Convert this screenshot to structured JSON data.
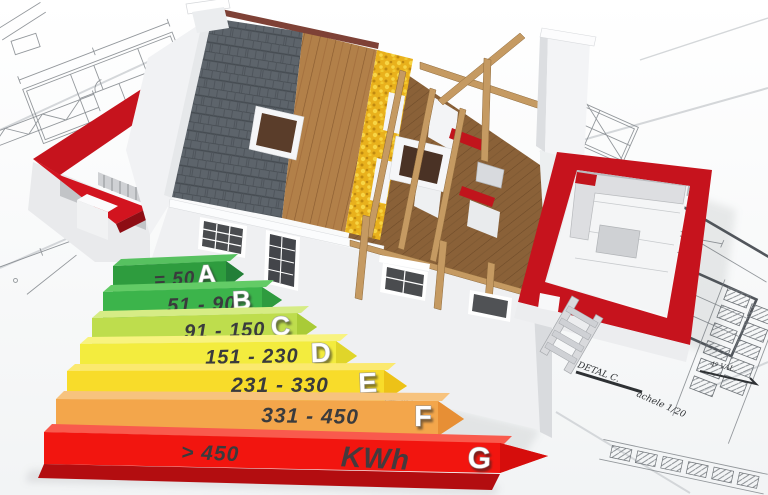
{
  "scene": {
    "description": "3D cutaway house under construction standing on architectural blueprints, with an energy-efficiency rating arrow scale in the foreground"
  },
  "energy_label": {
    "unit_label": "KWh",
    "ratings": [
      {
        "grade": "A",
        "range": "= 50",
        "front_color": "#2e9c3e",
        "top_color": "#57c160",
        "tip_color": "#237f38"
      },
      {
        "grade": "B",
        "range": "51 - 90",
        "front_color": "#3cb44b",
        "top_color": "#63cb66",
        "tip_color": "#2f9b3f"
      },
      {
        "grade": "C",
        "range": "91 - 150",
        "front_color": "#bedd4d",
        "top_color": "#d6ec85",
        "tip_color": "#a9cb37"
      },
      {
        "grade": "D",
        "range": "151 - 230",
        "front_color": "#f3ec3e",
        "top_color": "#f8f37f",
        "tip_color": "#e0d52a"
      },
      {
        "grade": "E",
        "range": "231 - 330",
        "front_color": "#f8dc2a",
        "top_color": "#fbe96f",
        "tip_color": "#edc217"
      },
      {
        "grade": "F",
        "range": "331 - 450",
        "front_color": "#f3a64b",
        "top_color": "#f7c37e",
        "tip_color": "#e78f35"
      },
      {
        "grade": "G",
        "range": "> 450",
        "front_color": "#f2150f",
        "top_color": "#f95a4d",
        "tip_color": "#d60d0c"
      }
    ]
  },
  "blueprints": {
    "annotations": [
      {
        "text": "DETAL C."
      },
      {
        "text": "achele 1/20"
      },
      {
        "text": "4º VAL."
      }
    ]
  },
  "palette": {
    "slate_roof": "#5d646b",
    "wood_sheathing": "#b28049",
    "insulation_yellow": "#e9b11c",
    "attic_floor_wood": "#8a6138",
    "red_walls": "#c6131d",
    "white_walls": "#eff0f2",
    "paper": "#ffffff",
    "line_ink": "#82878c",
    "range_text": "#3a3b3d"
  },
  "chart_data": {
    "type": "table",
    "title": "Energy efficiency scale",
    "categories": [
      "A",
      "B",
      "C",
      "D",
      "E",
      "F",
      "G"
    ],
    "ranges": [
      "= 50",
      "51 - 90",
      "91 - 150",
      "151 - 230",
      "231 - 330",
      "331 - 450",
      "> 450"
    ],
    "unit": "KWh",
    "colors": [
      "#2e9c3e",
      "#3cb44b",
      "#bedd4d",
      "#f3ec3e",
      "#f8dc2a",
      "#f3a64b",
      "#f2150f"
    ],
    "legend_position": "none",
    "grid": false
  }
}
